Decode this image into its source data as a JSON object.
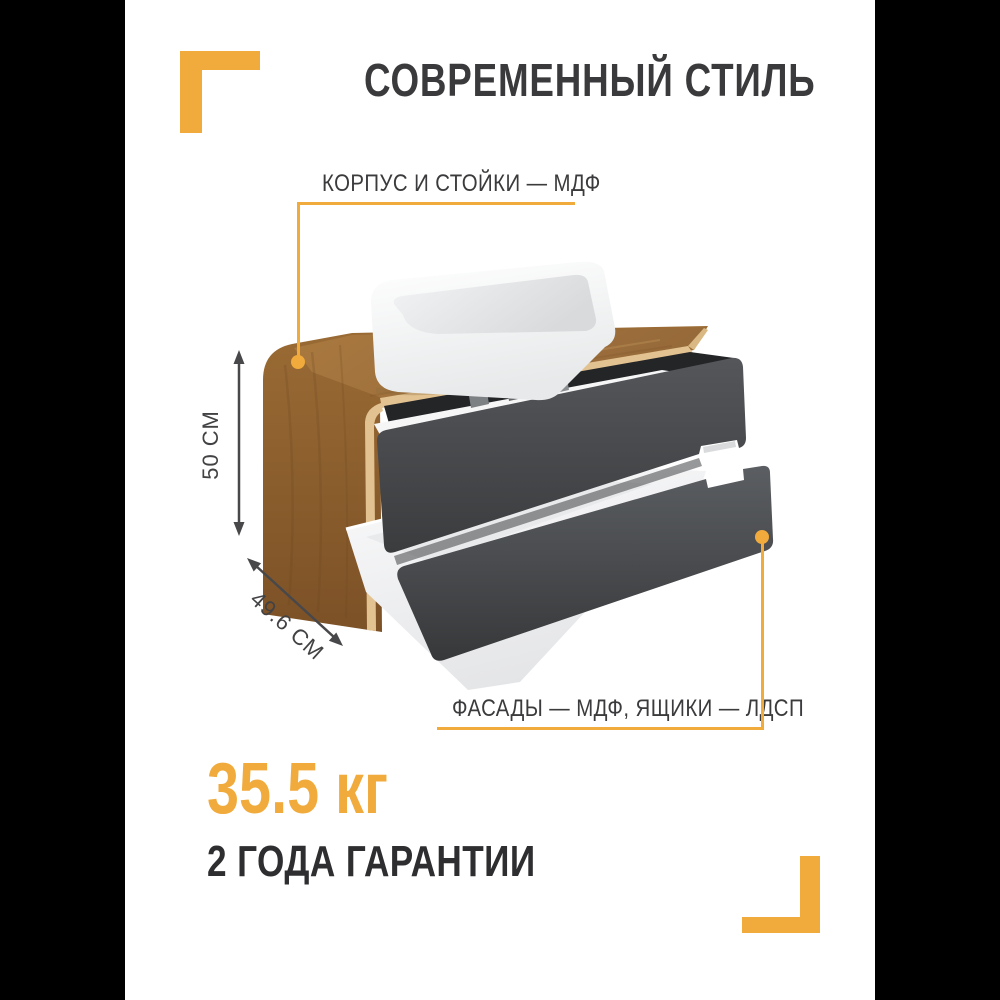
{
  "colors": {
    "accent": "#F0AB3C",
    "ink": "#3A3A3C",
    "bars": "#000000",
    "bg": "#FFFFFF"
  },
  "header": {
    "title": "СОВРЕМЕННЫЙ СТИЛЬ"
  },
  "callouts": {
    "top_label": "КОРПУС И СТОЙКИ — МДФ",
    "bottom_label": "ФАСАДЫ — МДФ, ЯЩИКИ — ЛДСП"
  },
  "dimensions": {
    "height_label": "50 СМ",
    "depth_label": "49.6 СМ"
  },
  "footer": {
    "weight": "35.5 кг",
    "warranty": "2 ГОДА ГАРАНТИИ"
  },
  "product": {
    "sink_color": "#FFFFFF",
    "wood_color": "#996A35",
    "drawer_color": "#45474A"
  }
}
